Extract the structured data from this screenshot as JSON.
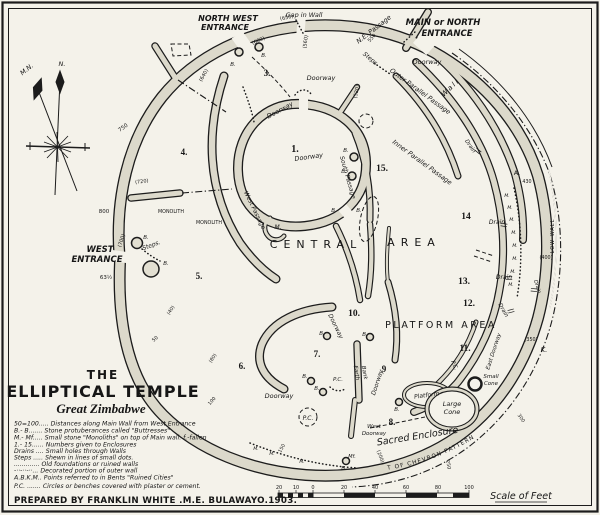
{
  "title": {
    "the": "THE",
    "main": "ELLIPTICAL TEMPLE",
    "sub": "Great Zimbabwe"
  },
  "credit": "PREPARED BY FRANKLIN WHITE .M.E. BULAWAYO.1903.",
  "legend_lines": [
    "50=100..... Distances along Main Wall from West Entrance",
    "B.- B....... Stone protuberances called \"Buttresses\"",
    "M.- Mf..... Small stone \"Monoliths\" on top of Main wall. f.-fallen",
    "1.- 15...... Numbers given to Enclosures",
    "Drains .... Small holes through Walls",
    "Steps ..... Shewn in lines of small dots.",
    "............. Old foundations or ruined walls",
    "-··-··-··... Decorated portion of outer wall",
    "A.B.K.M.. Points referred to in Bents \"Ruined Cities\"",
    "P.C. ....... Circles or benches covered with plaster or cement."
  ],
  "scale": {
    "label": "Scale of Feet",
    "ticks": {
      "t20l": "20",
      "t10l": "10",
      "t0": "0",
      "t20": "20",
      "t40": "40",
      "t60": "60",
      "t80": "80",
      "t100": "100"
    }
  },
  "compass": {
    "n": "N.",
    "mn": "M.N."
  },
  "labels": {
    "north_west": "NORTH WEST",
    "entrance": "ENTRANCE",
    "gap_in_wall": "Gap in Wall",
    "main_or_north": "MAIN or NORTH",
    "ne_passage": "N.E. Passage",
    "doorway": "Doorway",
    "wall": "Wall",
    "outer_parallel_passage": "Outer Parallel Passage",
    "inner_parallel_passage": "Inner Parallel Passage",
    "south_passage": "South Passage",
    "west_passage": "West Passage",
    "east_doorway": "East Doorway",
    "wd_west": "West",
    "steps": "Steps",
    "steps_dot": "Steps.",
    "west": "WEST",
    "monolith": "MONOLITH",
    "m_dot": "M.",
    "mf_dot": "Mf.",
    "b_dot": "B.",
    "a_dot": "A.",
    "k_dot": "K.",
    "pc": "P.C.",
    "central": "CENTRAL",
    "area": "AREA",
    "platform_area": "PLATFORM AREA",
    "sacred_enclosure": "Sacred Enclosure",
    "chevron_line": "LINE  INDICATING  EXTENT  OF  CHEVRON  PATTERN",
    "low_wall": "LOW WALL",
    "earth": "Earth",
    "bank": "Bank",
    "drain": "Drain",
    "large": "Large",
    "small": "Small",
    "cone": "Cone",
    "platform": "Platform"
  },
  "enclosures": {
    "e1": "1.",
    "e3": "3.",
    "e4": "4.",
    "e5": "5.",
    "e6": "6.",
    "e7": "7.",
    "e8": "8.",
    "e9": "9",
    "e10": "10.",
    "e11": "11.",
    "e12": "12.",
    "e13": "13.",
    "e14": "14",
    "e15": "15."
  },
  "distances": {
    "d40": "(40)",
    "d50": "50",
    "d80": "(80)",
    "d100": "100",
    "d150": "150",
    "d200": "(200)",
    "d250": "250",
    "d300": "300",
    "d350": "(350)",
    "d400": "(400)",
    "d430": "430",
    "d520": "(520)",
    "d550": "550",
    "d560": "(560)",
    "d600": "(600)",
    "d650": "(650)",
    "d640": "(640)",
    "d63": "63½",
    "d700": "(700)",
    "d720": "(720)",
    "d750": "750",
    "d800": "800"
  }
}
